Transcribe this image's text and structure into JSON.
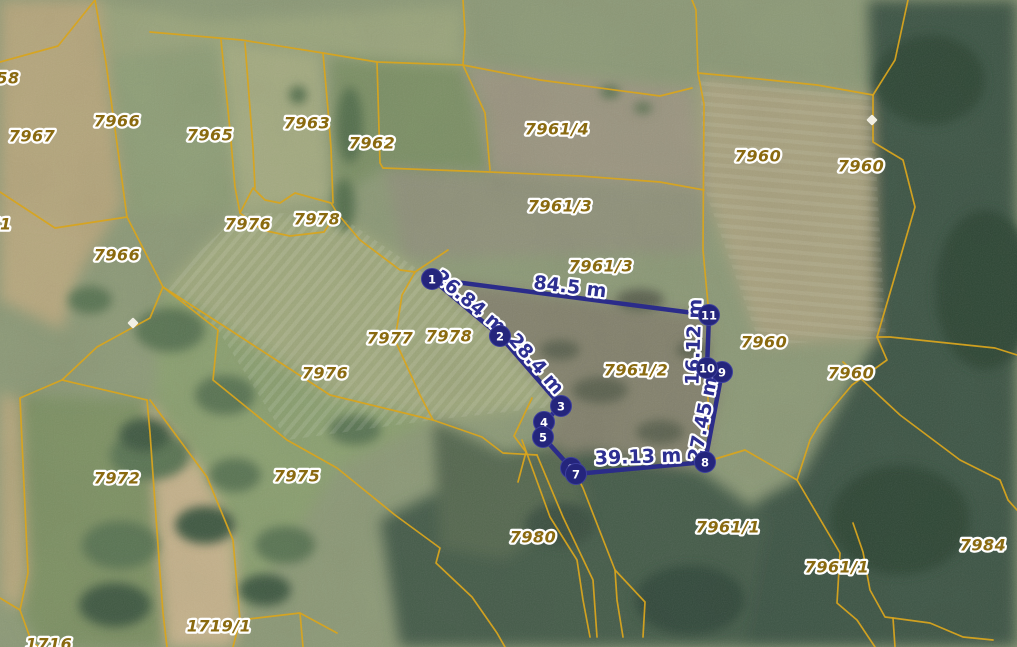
{
  "map": {
    "colors": {
      "boundary": "#d8a41e",
      "parcel_label": "#8a6a10",
      "measure_line": "#2b2c8a",
      "measure_label": "#2d2f91",
      "vertex_fill": "#24257c",
      "vertex_text": "#ffffff",
      "halo": "#ffffff"
    },
    "parcel_labels": [
      {
        "text": "58",
        "x": 8,
        "y": 78
      },
      {
        "text": "7967",
        "x": 32,
        "y": 136
      },
      {
        "text": "7966",
        "x": 117,
        "y": 121
      },
      {
        "text": "7965",
        "x": 210,
        "y": 135
      },
      {
        "text": "7963",
        "x": 307,
        "y": 123
      },
      {
        "text": "7962",
        "x": 372,
        "y": 143
      },
      {
        "text": "7961/4",
        "x": 557,
        "y": 129
      },
      {
        "text": "7960",
        "x": 758,
        "y": 156
      },
      {
        "text": "7960",
        "x": 861,
        "y": 166
      },
      {
        "text": "71",
        "x": 0,
        "y": 224
      },
      {
        "text": "7966",
        "x": 117,
        "y": 255
      },
      {
        "text": "7976",
        "x": 248,
        "y": 224
      },
      {
        "text": "7978",
        "x": 317,
        "y": 219
      },
      {
        "text": "7961/3",
        "x": 560,
        "y": 206
      },
      {
        "text": "7961/3",
        "x": 601,
        "y": 266
      },
      {
        "text": "7977",
        "x": 390,
        "y": 338
      },
      {
        "text": "7978",
        "x": 449,
        "y": 336
      },
      {
        "text": "7976",
        "x": 325,
        "y": 373
      },
      {
        "text": "7961/2",
        "x": 636,
        "y": 370
      },
      {
        "text": "7960",
        "x": 764,
        "y": 342
      },
      {
        "text": "7960",
        "x": 851,
        "y": 373
      },
      {
        "text": "7972",
        "x": 117,
        "y": 478
      },
      {
        "text": "7975",
        "x": 297,
        "y": 476
      },
      {
        "text": "7980",
        "x": 533,
        "y": 537
      },
      {
        "text": "7961/1",
        "x": 728,
        "y": 527
      },
      {
        "text": "7961/1",
        "x": 837,
        "y": 567
      },
      {
        "text": "7984",
        "x": 983,
        "y": 545
      },
      {
        "text": "1719/1",
        "x": 219,
        "y": 626
      },
      {
        "text": "1716",
        "x": 49,
        "y": 644
      }
    ],
    "boundaries": [
      [
        [
          95,
          0
        ],
        [
          106,
          63
        ],
        [
          127,
          217
        ]
      ],
      [
        [
          0,
          62
        ],
        [
          58,
          46
        ],
        [
          95,
          0
        ]
      ],
      [
        [
          0,
          192
        ],
        [
          55,
          228
        ],
        [
          127,
          217
        ]
      ],
      [
        [
          127,
          217
        ],
        [
          163,
          287
        ],
        [
          150,
          318
        ],
        [
          97,
          347
        ],
        [
          62,
          380
        ],
        [
          20,
          398
        ],
        [
          28,
          573
        ],
        [
          20,
          610
        ],
        [
          0,
          598
        ]
      ],
      [
        [
          20,
          610
        ],
        [
          32,
          643
        ],
        [
          40,
          647
        ]
      ],
      [
        [
          150,
          32
        ],
        [
          242,
          40
        ],
        [
          323,
          53
        ],
        [
          377,
          62
        ],
        [
          463,
          65
        ]
      ],
      [
        [
          463,
          0
        ],
        [
          465,
          32
        ],
        [
          463,
          65
        ]
      ],
      [
        [
          463,
          65
        ],
        [
          540,
          80
        ],
        [
          660,
          96
        ],
        [
          692,
          88
        ]
      ],
      [
        [
          692,
          0
        ],
        [
          696,
          10
        ],
        [
          698,
          73
        ]
      ],
      [
        [
          698,
          73
        ],
        [
          740,
          77
        ],
        [
          817,
          85
        ],
        [
          873,
          95
        ]
      ],
      [
        [
          463,
          65
        ],
        [
          485,
          113
        ],
        [
          490,
          170
        ]
      ],
      [
        [
          383,
          168
        ],
        [
          490,
          172
        ],
        [
          580,
          176
        ],
        [
          660,
          182
        ],
        [
          704,
          190
        ]
      ],
      [
        [
          221,
          40
        ],
        [
          230,
          130
        ],
        [
          235,
          187
        ],
        [
          240,
          213
        ]
      ],
      [
        [
          245,
          43
        ],
        [
          253,
          148
        ],
        [
          255,
          188
        ]
      ],
      [
        [
          323,
          53
        ],
        [
          328,
          110
        ],
        [
          331,
          148
        ],
        [
          333,
          203
        ]
      ],
      [
        [
          377,
          62
        ],
        [
          380,
          163
        ],
        [
          383,
          168
        ]
      ],
      [
        [
          240,
          213
        ],
        [
          253,
          188
        ],
        [
          265,
          200
        ],
        [
          280,
          203
        ],
        [
          295,
          193
        ],
        [
          331,
          203
        ],
        [
          337,
          213
        ],
        [
          324,
          232
        ],
        [
          290,
          236
        ],
        [
          262,
          230
        ],
        [
          240,
          213
        ]
      ],
      [
        [
          337,
          213
        ],
        [
          360,
          240
        ],
        [
          400,
          270
        ],
        [
          415,
          272
        ],
        [
          448,
          250
        ]
      ],
      [
        [
          415,
          272
        ],
        [
          402,
          295
        ],
        [
          395,
          340
        ],
        [
          420,
          395
        ],
        [
          433,
          420
        ]
      ],
      [
        [
          433,
          420
        ],
        [
          482,
          437
        ],
        [
          503,
          453
        ],
        [
          537,
          455
        ]
      ],
      [
        [
          522,
          440
        ],
        [
          550,
          517
        ],
        [
          577,
          560
        ],
        [
          583,
          600
        ],
        [
          590,
          637
        ]
      ],
      [
        [
          537,
          455
        ],
        [
          563,
          517
        ],
        [
          593,
          580
        ],
        [
          597,
          637
        ]
      ],
      [
        [
          532,
          398
        ],
        [
          514,
          436
        ],
        [
          526,
          452
        ],
        [
          518,
          482
        ]
      ],
      [
        [
          163,
          287
        ],
        [
          218,
          330
        ],
        [
          213,
          380
        ],
        [
          287,
          440
        ],
        [
          337,
          468
        ],
        [
          395,
          515
        ],
        [
          440,
          548
        ],
        [
          436,
          563
        ],
        [
          472,
          597
        ],
        [
          497,
          633
        ],
        [
          505,
          647
        ]
      ],
      [
        [
          163,
          287
        ],
        [
          230,
          330
        ],
        [
          330,
          395
        ],
        [
          433,
          420
        ]
      ],
      [
        [
          62,
          380
        ],
        [
          147,
          400
        ]
      ],
      [
        [
          147,
          400
        ],
        [
          150,
          433
        ],
        [
          160,
          573
        ],
        [
          163,
          613
        ],
        [
          167,
          647
        ]
      ],
      [
        [
          150,
          400
        ],
        [
          207,
          477
        ],
        [
          233,
          540
        ],
        [
          240,
          620
        ],
        [
          233,
          647
        ]
      ],
      [
        [
          240,
          620
        ],
        [
          300,
          613
        ],
        [
          337,
          633
        ]
      ],
      [
        [
          300,
          613
        ],
        [
          303,
          647
        ]
      ],
      [
        [
          576,
          474
        ],
        [
          583,
          488
        ],
        [
          615,
          570
        ],
        [
          617,
          600
        ],
        [
          623,
          637
        ]
      ],
      [
        [
          615,
          570
        ],
        [
          645,
          602
        ],
        [
          643,
          637
        ]
      ],
      [
        [
          698,
          73
        ],
        [
          704,
          104
        ],
        [
          703,
          250
        ],
        [
          709,
          315
        ]
      ],
      [
        [
          709,
          315
        ],
        [
          707,
          368
        ],
        [
          709,
          430
        ],
        [
          705,
          462
        ]
      ],
      [
        [
          705,
          462
        ],
        [
          745,
          450
        ],
        [
          797,
          480
        ],
        [
          840,
          553
        ],
        [
          837,
          603
        ],
        [
          857,
          620
        ],
        [
          875,
          647
        ]
      ],
      [
        [
          908,
          0
        ],
        [
          895,
          60
        ],
        [
          873,
          95
        ]
      ],
      [
        [
          873,
          95
        ],
        [
          873,
          142
        ],
        [
          903,
          160
        ],
        [
          915,
          207
        ],
        [
          890,
          293
        ],
        [
          877,
          337
        ]
      ],
      [
        [
          877,
          337
        ],
        [
          887,
          360
        ],
        [
          852,
          385
        ],
        [
          820,
          423
        ],
        [
          810,
          440
        ],
        [
          797,
          480
        ]
      ],
      [
        [
          877,
          337
        ],
        [
          890,
          337
        ],
        [
          995,
          348
        ],
        [
          1017,
          355
        ]
      ],
      [
        [
          843,
          362
        ],
        [
          900,
          415
        ],
        [
          960,
          460
        ],
        [
          1000,
          480
        ],
        [
          1008,
          500
        ],
        [
          1017,
          510
        ]
      ],
      [
        [
          853,
          523
        ],
        [
          863,
          552
        ],
        [
          870,
          590
        ],
        [
          885,
          617
        ],
        [
          893,
          618
        ],
        [
          930,
          623
        ],
        [
          963,
          637
        ],
        [
          993,
          640
        ]
      ],
      [
        [
          893,
          618
        ],
        [
          895,
          647
        ]
      ]
    ],
    "measurement": {
      "polygon": [
        [
          432,
          279
        ],
        [
          500,
          336
        ],
        [
          561,
          406
        ],
        [
          544,
          422
        ],
        [
          543,
          437
        ],
        [
          571,
          468
        ],
        [
          576,
          474
        ],
        [
          705,
          462
        ],
        [
          722,
          372
        ],
        [
          707,
          368
        ],
        [
          709,
          315
        ]
      ],
      "vertices": [
        {
          "n": "1",
          "x": 432,
          "y": 279
        },
        {
          "n": "2",
          "x": 500,
          "y": 336
        },
        {
          "n": "3",
          "x": 561,
          "y": 406
        },
        {
          "n": "4",
          "x": 544,
          "y": 422
        },
        {
          "n": "5",
          "x": 543,
          "y": 437
        },
        {
          "n": "6",
          "x": 571,
          "y": 468
        },
        {
          "n": "7",
          "x": 576,
          "y": 474
        },
        {
          "n": "8",
          "x": 705,
          "y": 462
        },
        {
          "n": "9",
          "x": 722,
          "y": 372
        },
        {
          "n": "10",
          "x": 707,
          "y": 368
        },
        {
          "n": "11",
          "x": 709,
          "y": 315
        }
      ],
      "labels": [
        {
          "text": "26.84 m",
          "x": 470,
          "y": 302,
          "rot": 40
        },
        {
          "text": "28.4 m",
          "x": 536,
          "y": 364,
          "rot": 49
        },
        {
          "text": "84.5 m",
          "x": 570,
          "y": 287,
          "rot": 7
        },
        {
          "text": "16.12 m",
          "x": 694,
          "y": 342,
          "rot": -88
        },
        {
          "text": "27.45 m",
          "x": 703,
          "y": 419,
          "rot": -79
        },
        {
          "text": "39.13 m",
          "x": 638,
          "y": 457,
          "rot": -2
        }
      ]
    },
    "markers": [
      {
        "x": 133,
        "y": 323
      },
      {
        "x": 872,
        "y": 120
      }
    ]
  }
}
